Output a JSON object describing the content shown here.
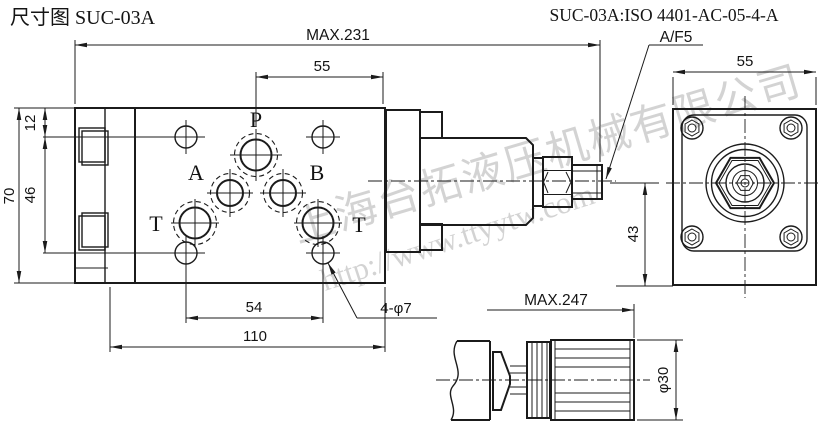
{
  "title": "尺寸图 SUC-03A",
  "spec": "SUC-03A:ISO 4401-AC-05-4-A",
  "wrench_label": "A/F5",
  "front_view": {
    "ports": {
      "p": "P",
      "a": "A",
      "b": "B",
      "t_left": "T",
      "t_right": "T"
    },
    "dimensions": {
      "overall_length": "MAX.231",
      "p_to_right_edge": "55",
      "top_to_bolt_row": "12",
      "bolt_row_spacing": "46",
      "body_height": "70",
      "bolt_col_spacing": "54",
      "body_width": "110",
      "mounting_holes": "4-φ7"
    }
  },
  "end_view": {
    "dimensions": {
      "flange_width": "55",
      "center_to_bottom": "43"
    }
  },
  "handle_view": {
    "dimensions": {
      "max_length": "MAX.247",
      "knob_diameter": "φ30"
    }
  },
  "watermark": {
    "company": "上海台拓液压机械有限公司",
    "url": "http://www.ttyytw.com"
  },
  "colors": {
    "background": "#ffffff",
    "line": "#1b1b1b",
    "watermark": "#c9c9c9"
  }
}
